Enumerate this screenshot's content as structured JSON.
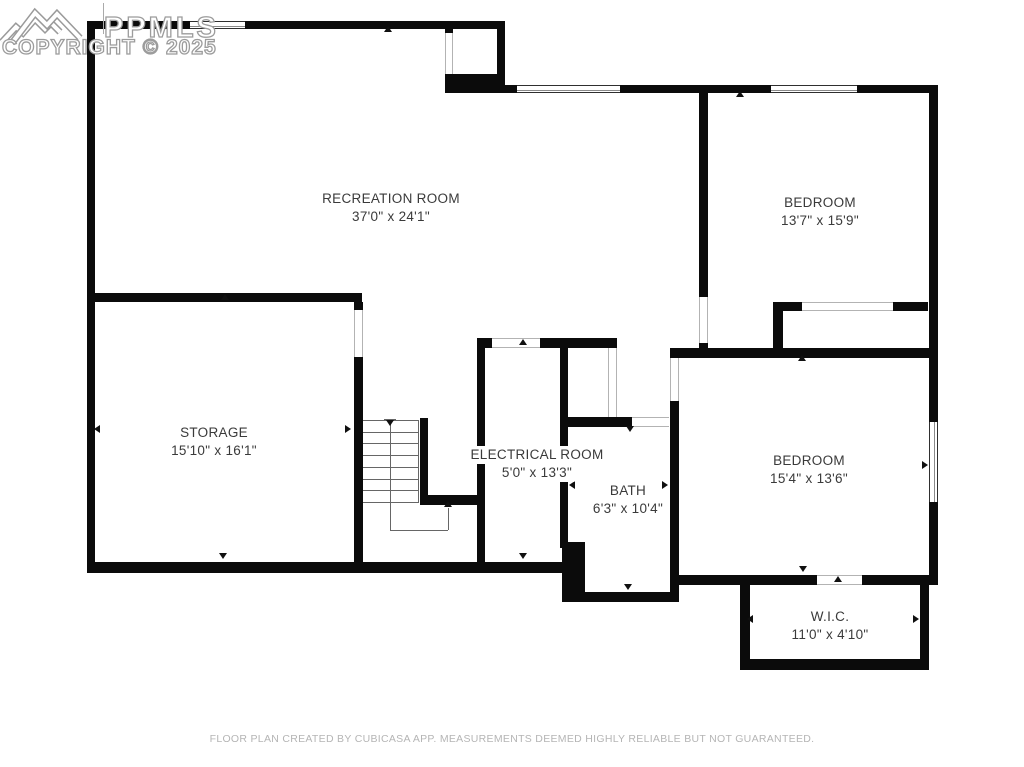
{
  "watermark": {
    "logo": "ppmls-mountain-logo",
    "line1": "PPMLS",
    "line2": "COPYRIGHT © 2025"
  },
  "footer": {
    "text": "FLOOR PLAN CREATED BY CUBICASA APP. MEASUREMENTS DEEMED HIGHLY RELIABLE BUT NOT GUARANTEED."
  },
  "rooms": [
    {
      "name": "RECREATION ROOM",
      "dims": "37'0\" x 24'1\"",
      "cx": 391,
      "cy": 199
    },
    {
      "name": "BEDROOM",
      "dims": "13'7\" x 15'9\"",
      "cx": 820,
      "cy": 203
    },
    {
      "name": "STORAGE",
      "dims": "15'10\" x 16'1\"",
      "cx": 214,
      "cy": 433
    },
    {
      "name": "ELECTRICAL ROOM",
      "dims": "5'0\" x 13'3\"",
      "cx": 537,
      "cy": 455
    },
    {
      "name": "BATH",
      "dims": "6'3\" x 10'4\"",
      "cx": 628,
      "cy": 491
    },
    {
      "name": "BEDROOM",
      "dims": "15'4\" x 13'6\"",
      "cx": 809,
      "cy": 461
    },
    {
      "name": "W.I.C.",
      "dims": "11'0\" x 4'10\"",
      "cx": 830,
      "cy": 617
    }
  ],
  "colors": {
    "wall": "#0b0b0b",
    "label": "#3a3a3a",
    "footer": "#b5b5b5",
    "watermark_stroke": "#9c9c9c",
    "thin_line": "#666666",
    "opening_line": "#b3b3b3"
  },
  "floorplan": {
    "walls": [
      [
        87,
        21,
        8,
        552
      ],
      [
        87,
        21,
        418,
        8
      ],
      [
        445,
        21,
        8,
        12
      ],
      [
        445,
        74,
        60,
        19
      ],
      [
        497,
        21,
        8,
        72
      ],
      [
        497,
        85,
        441,
        8
      ],
      [
        929,
        85,
        9,
        500
      ],
      [
        87,
        562,
        476,
        11
      ],
      [
        562,
        542,
        23,
        60
      ],
      [
        583,
        592,
        96,
        10
      ],
      [
        671,
        575,
        258,
        10
      ],
      [
        740,
        575,
        10,
        95
      ],
      [
        920,
        575,
        9,
        95
      ],
      [
        740,
        659,
        189,
        11
      ],
      [
        87,
        293,
        275,
        9
      ],
      [
        354,
        302,
        9,
        8
      ],
      [
        354,
        357,
        9,
        216
      ],
      [
        420,
        418,
        8,
        87
      ],
      [
        420,
        495,
        57,
        10
      ],
      [
        477,
        338,
        8,
        235
      ],
      [
        477,
        338,
        15,
        10
      ],
      [
        540,
        338,
        77,
        10
      ],
      [
        560,
        338,
        8,
        210
      ],
      [
        560,
        417,
        72,
        10
      ],
      [
        670,
        401,
        9,
        201
      ],
      [
        670,
        348,
        267,
        10
      ],
      [
        699,
        93,
        9,
        204
      ],
      [
        699,
        343,
        9,
        10
      ],
      [
        773,
        302,
        29,
        9
      ],
      [
        893,
        302,
        35,
        9
      ],
      [
        773,
        302,
        10,
        50
      ]
    ],
    "windows": [
      {
        "r": [
          190,
          21,
          55,
          8
        ],
        "o": "h"
      },
      {
        "r": [
          517,
          85,
          103,
          8
        ],
        "o": "h"
      },
      {
        "r": [
          771,
          85,
          86,
          8
        ],
        "o": "h"
      },
      {
        "r": [
          929,
          422,
          9,
          80
        ],
        "o": "v"
      }
    ],
    "openings": [
      {
        "r": [
          445,
          33,
          8,
          41
        ],
        "o": "v"
      },
      {
        "r": [
          699,
          297,
          9,
          46
        ],
        "o": "v"
      },
      {
        "r": [
          354,
          310,
          9,
          47
        ],
        "o": "v"
      },
      {
        "r": [
          492,
          338,
          48,
          10
        ],
        "o": "h"
      },
      {
        "r": [
          608,
          348,
          9,
          69
        ],
        "o": "v"
      },
      {
        "r": [
          632,
          417,
          37,
          10
        ],
        "o": "h"
      },
      {
        "r": [
          670,
          358,
          9,
          43
        ],
        "o": "v"
      },
      {
        "r": [
          802,
          302,
          91,
          9
        ],
        "o": "h"
      },
      {
        "r": [
          817,
          575,
          45,
          10
        ],
        "o": "h"
      }
    ],
    "arrows": [
      [
        388,
        31,
        "up"
      ],
      [
        740,
        96,
        "up"
      ],
      [
        225,
        299,
        "up"
      ],
      [
        523,
        344,
        "up"
      ],
      [
        630,
        431,
        "down"
      ],
      [
        802,
        360,
        "up"
      ],
      [
        573,
        486,
        "left"
      ],
      [
        666,
        486,
        "right"
      ],
      [
        98,
        430,
        "left"
      ],
      [
        349,
        430,
        "right"
      ],
      [
        751,
        620,
        "left"
      ],
      [
        917,
        620,
        "right"
      ],
      [
        838,
        581,
        "up"
      ],
      [
        803,
        571,
        "down"
      ],
      [
        628,
        589,
        "down"
      ],
      [
        223,
        558,
        "down"
      ],
      [
        523,
        558,
        "down"
      ],
      [
        926,
        466,
        "right"
      ],
      [
        390,
        425,
        "down"
      ],
      [
        448,
        506,
        "up"
      ]
    ],
    "stairs": {
      "treads": {
        "x": 363,
        "w": 55,
        "y0": 420,
        "count": 8,
        "step": 11.7
      },
      "edge": [
        418,
        420,
        1,
        83
      ],
      "tick": [
        384,
        419,
        12,
        1
      ],
      "walk": [
        [
          390,
          424
        ],
        [
          390,
          530
        ],
        [
          448,
          530
        ],
        [
          448,
          508
        ]
      ]
    }
  }
}
